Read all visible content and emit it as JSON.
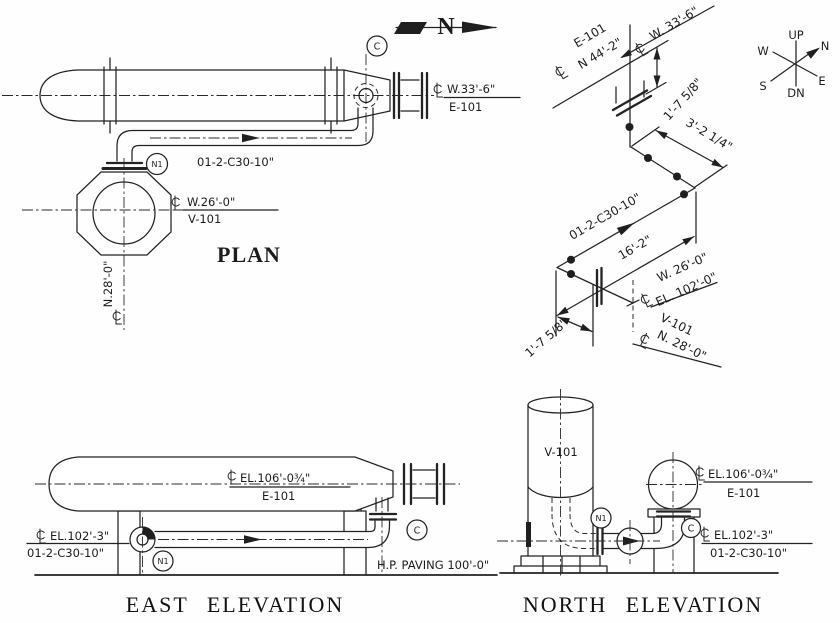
{
  "colors": {
    "ink": "#1f1f1f",
    "paper": "#ffffff"
  },
  "north_arrow": {
    "label": "N"
  },
  "compass": {
    "up": "UP",
    "down": "DN",
    "north": "N",
    "south": "S",
    "east": "E",
    "west": "W"
  },
  "plan": {
    "title": "PLAN",
    "nozzle_c": "C",
    "nozzle_n1": "N1",
    "pipe_line": "01-2-C30-10\"",
    "e101_coord": "W.33'-6\"",
    "e101_tag": "E-101",
    "v101_coord": "W.26'-0\"",
    "v101_tag": "V-101",
    "v101_north": "N.28'-0\""
  },
  "isometric": {
    "e101_tag": "E-101",
    "e101_north": "N 44'-2\"",
    "e101_west": "W. 33'-6\"",
    "drop_dim": "1'-7 5/8\"",
    "east_dim": "3'-2 1/4\"",
    "pipe_line": "01-2-C30-10\"",
    "run_dim": "16'-2\"",
    "v101_west": "W. 26'-0\"",
    "v101_el": "EL. 102'-0\"",
    "v101_tag": "V-101",
    "v101_north": "N. 28'-0\"",
    "riser_dim": "1'-7 5/8\""
  },
  "east_elevation": {
    "title": "EAST ELEVATION",
    "e101_el": "EL.106'-0¾\"",
    "e101_tag": "E-101",
    "pipe_el": "EL.102'-3\"",
    "pipe_line": "01-2-C30-10\"",
    "nozzle_n1": "N1",
    "nozzle_c": "C",
    "paving": "H.P. PAVING 100'-0\""
  },
  "north_elevation": {
    "title": "NORTH ELEVATION",
    "v101_tag": "V-101",
    "e101_el": "EL.106'-0¾\"",
    "e101_tag": "E-101",
    "pipe_el": "EL.102'-3\"",
    "pipe_line": "01-2-C30-10\"",
    "nozzle_n1": "N1",
    "nozzle_c": "C"
  }
}
